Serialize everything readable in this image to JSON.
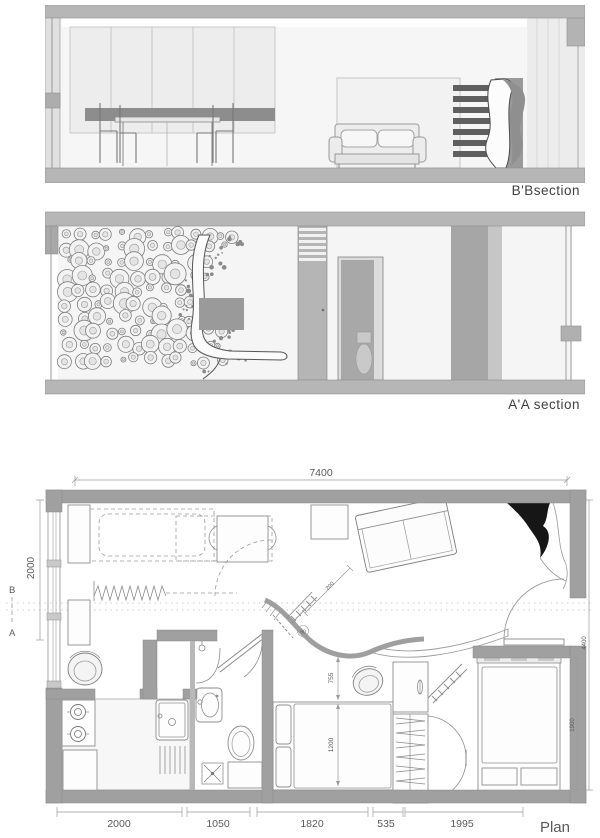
{
  "sections": {
    "bb_label": "B'Bsection",
    "aa_label": "A'A section"
  },
  "plan": {
    "label": "Plan",
    "dim_top": "7400",
    "dim_left": "2000",
    "marker_b": "B",
    "marker_a": "A",
    "dims_bottom": [
      "2000",
      "1050",
      "1820",
      "535",
      "1995"
    ],
    "dim_right_outer": "4400",
    "dim_right_inner": "1900",
    "dim_clearance": "755",
    "dim_bed_width": "1200",
    "dim_diag": "200",
    "angle_label": "90"
  },
  "colors": {
    "wall_gray": "#a0a0a0",
    "frame_bar": "#b6b6b6",
    "dark_slat": "#5f5f5f",
    "swoosh_black": "#161616",
    "line_gray": "#8e8e8e"
  }
}
